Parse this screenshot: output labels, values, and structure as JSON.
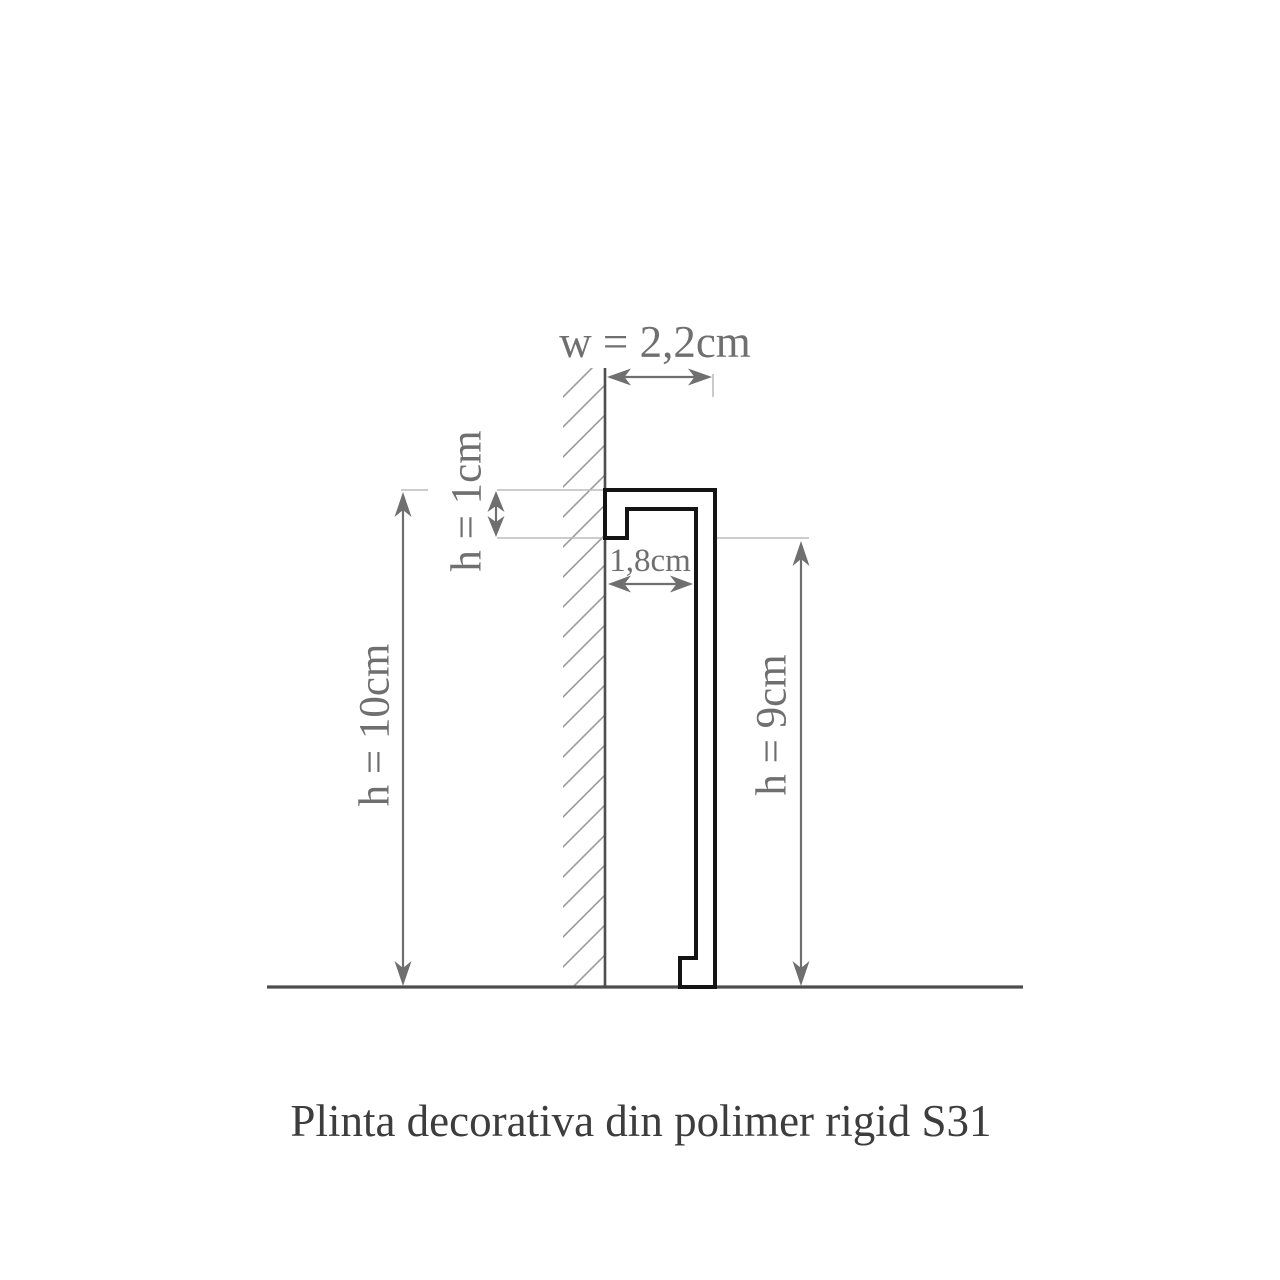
{
  "colors": {
    "background": "#ffffff",
    "outline": "#141414",
    "structure": "#4d4d4d",
    "hatch": "#9b9b9b",
    "dim": "#6f6f6f",
    "ext": "#bcbcbc",
    "title": "#3d3d3d"
  },
  "diagram": {
    "title": "Plinta decorativa din polimer rigid S31",
    "labels": {
      "width": "w = 2,2cm",
      "lip_height": "h = 1cm",
      "inner_width": "1,8cm",
      "total_height": "h = 10cm",
      "front_height": "h = 9cm"
    }
  }
}
